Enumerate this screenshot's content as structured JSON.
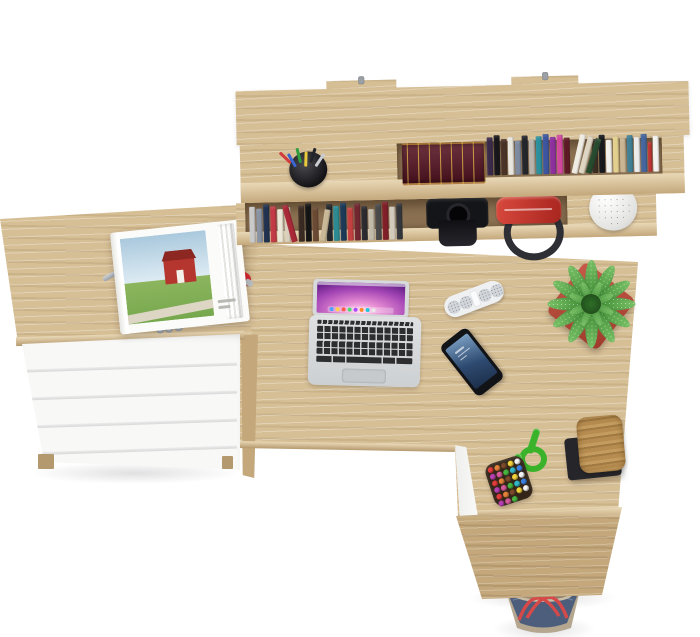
{
  "meta": {
    "type": "product-photo",
    "subject": "Top view of an L-shaped oak office desk set with wall hutch, white drawer chest and styled props",
    "background": "#ffffff"
  },
  "colors": {
    "bg": "#ffffff",
    "oak": "#d6be95",
    "oak_dark": "#c4a87c",
    "oak_edge": "#e9d8b6",
    "oak_deep": "#b5996e",
    "recess": "#8a7051",
    "white_panel": "#f8f8f7",
    "panel_gap": "#d8d8d8"
  },
  "furniture": {
    "hutch": {
      "label": "wall-mounted hutch with two shelves",
      "mount_hooks": 2
    },
    "drawer_chest": {
      "label": "white drawer chest with oak top",
      "drawers": 5,
      "gap_count": 4
    },
    "desk": {
      "label": "L-shaped oak desk with white inner panels"
    }
  },
  "books": {
    "feature_book": {
      "color": "#571523",
      "gilt": "#cfa53c"
    },
    "upper_spines": [
      {
        "c": "#3a2a4a",
        "h": 38
      },
      {
        "c": "#17171b",
        "h": 40
      },
      {
        "c": "#4a3226",
        "h": 36
      },
      {
        "c": "#e8e5dd",
        "h": 38
      },
      {
        "c": "#7e8aa0",
        "h": 34
      },
      {
        "c": "#23262b",
        "h": 39
      },
      {
        "c": "#b8b4ac",
        "h": 35
      },
      {
        "c": "#2b8f9e",
        "h": 38
      },
      {
        "c": "#3c55a0",
        "h": 40
      },
      {
        "c": "#8e2f9e",
        "h": 37
      },
      {
        "c": "#d2489e",
        "h": 39
      },
      {
        "c": "#5e1a24",
        "h": 36
      },
      {
        "c": "#efece4",
        "h": 40,
        "r": 14
      },
      {
        "c": "#ded6c2",
        "h": 38,
        "r": 16
      },
      {
        "c": "#274a2e",
        "h": 36,
        "r": 18
      },
      {
        "c": "#3a2d22",
        "h": 34
      },
      {
        "c": "#16181c",
        "h": 38
      },
      {
        "c": "#f2f0ea",
        "h": 33
      },
      {
        "c": "#e3d08e",
        "h": 36
      },
      {
        "c": "#c9b592",
        "h": 34
      },
      {
        "c": "#417f95",
        "h": 37
      },
      {
        "c": "#ececec",
        "h": 35
      },
      {
        "c": "#44659e",
        "h": 38
      },
      {
        "c": "#c03434",
        "h": 30,
        "w": 4
      },
      {
        "c": "#f4f2ee",
        "h": 36
      }
    ],
    "lower_spines": [
      {
        "c": "#c9c9c9",
        "h": 36
      },
      {
        "c": "#8a93a3",
        "h": 34
      },
      {
        "c": "#20324f",
        "h": 38
      },
      {
        "c": "#c23a45",
        "h": 36
      },
      {
        "c": "#ece6d6",
        "h": 33
      },
      {
        "c": "#d9d0bd",
        "h": 35
      },
      {
        "c": "#a82836",
        "h": 38,
        "r": -14
      },
      {
        "c": "#3a2b22",
        "h": 36
      },
      {
        "c": "#141414",
        "h": 38
      },
      {
        "c": "#6b4a33",
        "h": 34
      },
      {
        "c": "#c9b897",
        "h": 32,
        "r": 10
      },
      {
        "c": "#24282c",
        "h": 37
      },
      {
        "c": "#2b8a92",
        "h": 35
      },
      {
        "c": "#1c3a57",
        "h": 38
      },
      {
        "c": "#c44040",
        "h": 33
      },
      {
        "c": "#722630",
        "h": 37
      },
      {
        "c": "#2b2b2f",
        "h": 34
      },
      {
        "c": "#c2baa9",
        "h": 31
      },
      {
        "c": "#4a4a4a",
        "h": 36
      },
      {
        "c": "#801f28",
        "h": 38
      },
      {
        "c": "#d2cabb",
        "h": 33
      },
      {
        "c": "#33373c",
        "h": 36
      }
    ]
  },
  "props": {
    "pen_cup": {
      "cup": "#26262b",
      "pens": [
        "#d23b3b",
        "#3b66d2",
        "#2f9e3f",
        "#e8c93b",
        "#23232a",
        "#c9ccd2"
      ]
    },
    "camera_bag": {
      "color": "#141518"
    },
    "red_duffel": {
      "color": "#c83a2e",
      "strap": "#2e2f35"
    },
    "shelf_plant": {
      "pot": "#f4f4f2",
      "foliage": "#6e2129"
    },
    "laptop": {
      "body": "#d7d9db",
      "keys": "#2c2e30",
      "wallpaper": [
        "#ffd9ee",
        "#e58ad2",
        "#a244b4",
        "#52167a",
        "#1c0a36"
      ],
      "dock_dots": [
        "#4aa3ff",
        "#ffd24a",
        "#ff5a4a",
        "#4ade6e",
        "#b04aff",
        "#ff8a2a",
        "#24c8d8",
        "#e8e8e8"
      ]
    },
    "speaker": {
      "body": "#eef0f2",
      "grille": "#d2d6da"
    },
    "phone": {
      "body": "#111317",
      "screen_top": "#7ca0c4",
      "screen_bottom": "#1c2f4a"
    },
    "desk_plant": {
      "pot": "#b44a38",
      "leaf_light": "#7cc469",
      "leaf_dark": "#3e8c33",
      "outer_leaves": 12,
      "inner_leaves": 8
    },
    "rope": {
      "color": "#3ab32b"
    },
    "bead_bag": {
      "base": "#332619",
      "bead_count": 28,
      "beads": [
        "#e23b3b",
        "#3b7fe2",
        "#f2d23b",
        "#47b53f",
        "#e2823b",
        "#b53fb0",
        "#f4f4f4",
        "#30b8c9",
        "#7a4a2a",
        "#d45a9a"
      ]
    },
    "cork_stool": {
      "cork": "#b68c50",
      "base": "#26262a"
    },
    "magazine": {
      "page": "#fbfbf9",
      "sky": "#aac9dd",
      "grass": "#76a84e",
      "barn": "#b5362e",
      "roof": "#8c2721",
      "path": "#ddd6c4"
    },
    "car_key": {
      "body": "#1c1c1f",
      "blade": "#b9bcc0"
    },
    "pocket_knife": {
      "body": "#a81a22"
    },
    "keychain": {
      "fob": "#c13038",
      "key_metal": "#b6bac0",
      "key_angles": [
        22,
        38,
        52,
        66,
        80
      ],
      "key_lengths": [
        46,
        42,
        44,
        40,
        38
      ]
    },
    "tote_bag": {
      "denim": "#4c5e7b",
      "trim": "#b5a78f",
      "straps": "#d64949",
      "opening": "#8d8170"
    }
  },
  "items": [
    "wall hutch",
    "upper book row",
    "lower book row",
    "antique gilt book set",
    "pen cup",
    "camera bag",
    "red duffel bag",
    "white pot with maroon succulent",
    "white drawer chest",
    "car key remote",
    "red pocket knife",
    "keychain with keys",
    "open magazine with red barn photo",
    "L-shaped desk",
    "silver laptop",
    "white portable speaker",
    "smartphone",
    "green succulent in red square pot",
    "green paracord",
    "bead pouch",
    "cork stool on black base",
    "denim tote bag"
  ]
}
